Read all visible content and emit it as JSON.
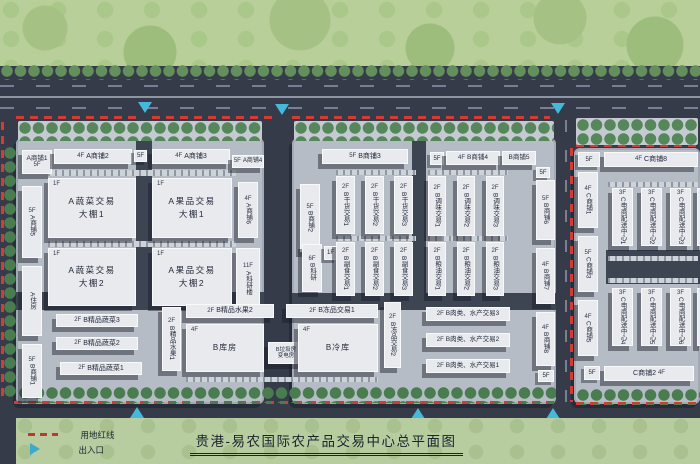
{
  "title": "贵港-易农国际农产品交易中心总平面图",
  "legend": {
    "boundary_label": "用地红线",
    "entrance_label": "出入口"
  },
  "colors": {
    "boundary_red": "#d63a35",
    "entrance_cyan": "#45b9dc",
    "field_green": "#b9cf99",
    "road_dark": "#353b48",
    "platform_gray": "#b6bcc6",
    "building_light": "#e8eaee"
  },
  "floors": {
    "f5": "5F",
    "f4": "4F",
    "f1": "1F"
  },
  "buildings": {
    "a_shop1": {
      "label": "A商铺1",
      "floor": "5F"
    },
    "a_shop2": {
      "label": "A商铺2",
      "floor": "4F"
    },
    "a_shop3": {
      "label": "A商铺3",
      "floor": "4F"
    },
    "a_shop4": {
      "label": "A商铺4",
      "floor": "5F"
    },
    "a_shop5": {
      "label": "A商铺5",
      "floor": "5F"
    },
    "a_shop6": {
      "label": "A商铺6",
      "floor": "4F"
    },
    "a_house": {
      "label": "A住房",
      "floor": ""
    },
    "a_research": {
      "label": "A科研楼",
      "floor": "11F"
    },
    "a_veg_shed1": {
      "floor": "1F",
      "line1": "A蔬菜交易",
      "line2": "大棚1"
    },
    "a_veg_shed2": {
      "floor": "1F",
      "line1": "A蔬菜交易",
      "line2": "大棚2"
    },
    "a_fruit_shed1": {
      "floor": "1F",
      "line1": "A果品交易",
      "line2": "大棚1"
    },
    "a_fruit_shed2": {
      "floor": "1F",
      "line1": "A果品交易",
      "line2": "大棚2"
    },
    "b_shop1": {
      "label": "B商铺1",
      "floor": "5F"
    },
    "b_shop2": {
      "label": "B商铺2",
      "floor": "5F"
    },
    "b_shop3": {
      "label": "B商铺3",
      "floor": "5F"
    },
    "b_shop4": {
      "label": "B商铺4",
      "floor": "4F"
    },
    "b_shop5": {
      "label": "B商铺5",
      "floor": "5F"
    },
    "b_shop6": {
      "label": "B商铺6",
      "floor": "5F"
    },
    "b_shop7": {
      "label": "B商铺7",
      "floor": "4F"
    },
    "b_shop8": {
      "label": "B商铺8",
      "floor": "4F"
    },
    "b_research": {
      "label": "B科研",
      "floor": "6F",
      "annex_floor": "1F"
    },
    "b_pveg1": {
      "label": "B精品蔬菜1",
      "floor": "2F"
    },
    "b_pveg2": {
      "label": "B精品蔬菜2",
      "floor": "2F"
    },
    "b_pveg3": {
      "label": "B精品蔬菜3",
      "floor": "2F"
    },
    "b_dry1": {
      "label": "B干货交易1",
      "floor": "2F"
    },
    "b_dry2": {
      "label": "B干货交易2",
      "floor": "2F"
    },
    "b_dry3": {
      "label": "B干货交易3",
      "floor": "2F"
    },
    "b_food1": {
      "label": "B副食交易1",
      "floor": "2F"
    },
    "b_food2": {
      "label": "B副食交易2",
      "floor": "2F"
    },
    "b_food3": {
      "label": "B副食交易3",
      "floor": "2F"
    },
    "b_season1": {
      "label": "B调味交易1",
      "floor": "2F"
    },
    "b_season2": {
      "label": "B调味交易2",
      "floor": "2F"
    },
    "b_season3": {
      "label": "B调味交易3",
      "floor": "2F"
    },
    "b_grain1": {
      "label": "B粮油交易1",
      "floor": "2F"
    },
    "b_grain2": {
      "label": "B粮油交易2",
      "floor": "2F"
    },
    "b_grain3": {
      "label": "B粮油交易3",
      "floor": "2F"
    },
    "b_pfruit1": {
      "label": "B精品水果1",
      "floor": "2F"
    },
    "b_pfruit2": {
      "label": "B精品水果2",
      "floor": "2F"
    },
    "b_warehouse": {
      "label": "B库房",
      "floor": "4F"
    },
    "b_utility": {
      "line1": "B垃圾房",
      "line2": "变电房"
    },
    "b_frozen1": {
      "label": "B冻品交易1",
      "floor": "2F"
    },
    "b_frozen2": {
      "label": "B冻品交易2",
      "floor": "2F"
    },
    "b_coldstore": {
      "label": "B冷库",
      "floor": "4F"
    },
    "b_meat1": {
      "label": "B肉类、水产交易1",
      "floor": "2F"
    },
    "b_meat2": {
      "label": "B肉类、水产交易2",
      "floor": "2F"
    },
    "b_meat3": {
      "label": "B肉类、水产交易3",
      "floor": "2F"
    },
    "c_shop1": {
      "label": "C商铺1",
      "floor": "4F"
    },
    "c_shop2": {
      "label": "C商铺2",
      "floor": "4F"
    },
    "c_shop3": {
      "label": "C商铺3",
      "floor": "5F"
    },
    "c_shop5": {
      "label": "C商铺5",
      "floor": "4F"
    },
    "c_shop8": {
      "label": "C商铺8",
      "floor": "4F"
    },
    "c_ecom1": {
      "label": "C电商配送中心1",
      "floor": "3F"
    },
    "c_ecom2": {
      "label": "C电商配送中心2",
      "floor": "3F"
    },
    "c_ecom3": {
      "label": "C电商配送中心3",
      "floor": "3F"
    },
    "c_ecom4": {
      "label": "C电商配送中心4",
      "floor": "3F"
    },
    "c_ecom5": {
      "label": "C电商配送中心5",
      "floor": "3F"
    },
    "c_ecom6": {
      "label": "C电商配送中心6",
      "floor": "3F"
    }
  }
}
